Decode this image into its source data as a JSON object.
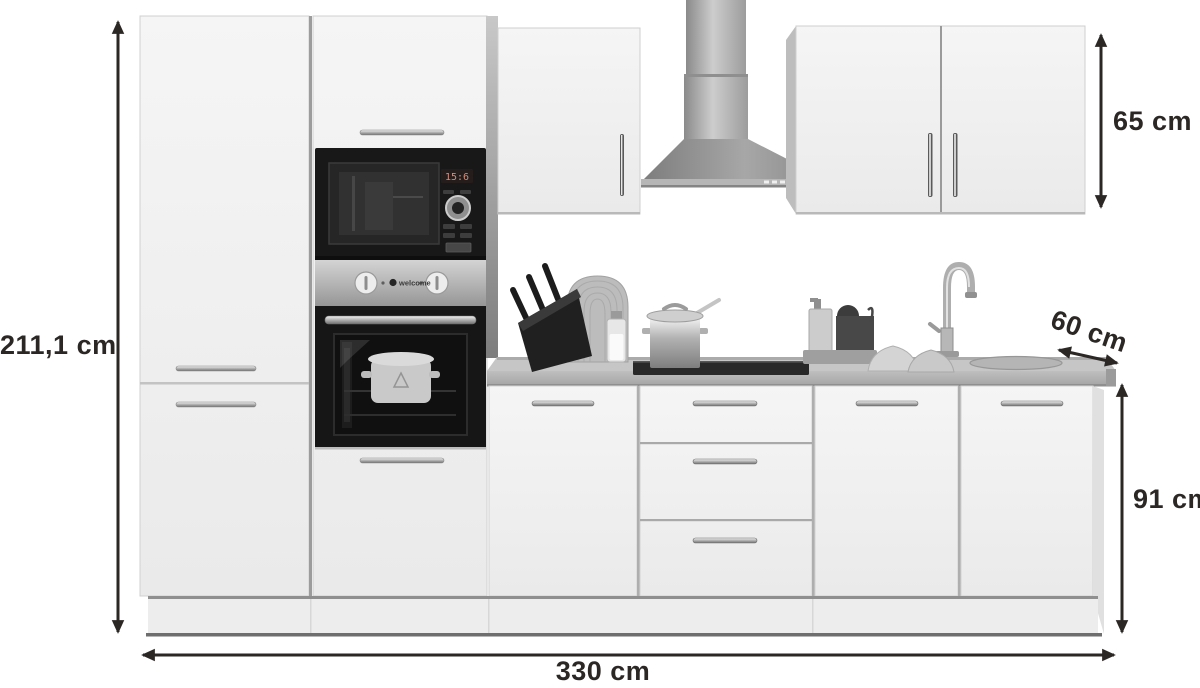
{
  "annotations": {
    "total_height_label": "211,1 cm",
    "wall_unit_height_label": "65 cm",
    "worktop_depth_label": "60 cm",
    "base_unit_height_label": "91 cm",
    "total_width_label": "330 cm"
  },
  "appliances": {
    "microwave_display": "15:6",
    "oven_brand_label": "welcome"
  },
  "scene": {
    "description_parts": [
      "tall-cabinet",
      "oven-housing-column",
      "built-in-microwave",
      "built-in-oven",
      "wall-cabinet-left",
      "chimney-range-hood",
      "wall-cabinet-right",
      "worktop",
      "cooktop",
      "base-cabinet-door",
      "drawer-unit",
      "base-cabinet-doors-right",
      "sink",
      "faucet",
      "knife-block",
      "cutting-board",
      "milk-bottle",
      "cooking-pot",
      "soap-dispenser",
      "dish-brush",
      "bowls",
      "plinth"
    ]
  },
  "colors": {
    "background": "#ffffff",
    "annotation_text": "#2b2724",
    "cabinet_front": "#f1f1f1",
    "cabinet_side": "#bfbfbf",
    "worktop": "#c0c0c0",
    "stainless_steel": "#a5a5a5",
    "appliance_black": "#171717",
    "microwave_display_text": "#cf8f7f"
  }
}
